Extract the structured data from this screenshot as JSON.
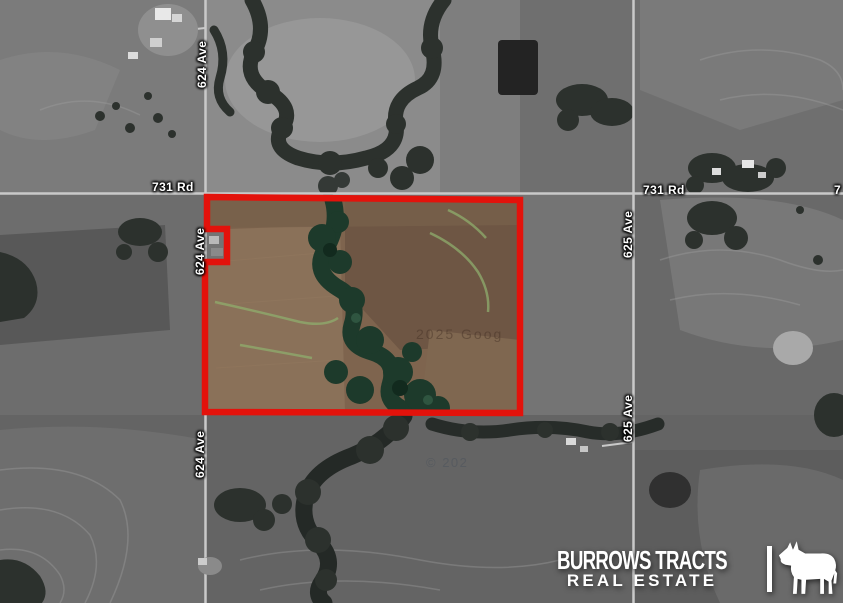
{
  "map": {
    "road_labels": [
      {
        "id": "624-ave-top",
        "text": "624 Ave"
      },
      {
        "id": "624-ave-mid",
        "text": "624 Ave"
      },
      {
        "id": "624-ave-bottom",
        "text": "624 Ave"
      },
      {
        "id": "625-ave-upper",
        "text": "625 Ave"
      },
      {
        "id": "625-ave-lower",
        "text": "625 Ave"
      },
      {
        "id": "731-rd-left",
        "text": "731 Rd"
      },
      {
        "id": "731-rd-right",
        "text": "731 Rd"
      },
      {
        "id": "731-rd-edge",
        "text": "7"
      }
    ],
    "watermarks": [
      {
        "id": "imagery-watermark-upper",
        "text": "2025 Goog"
      },
      {
        "id": "imagery-watermark-lower",
        "text": "© 202"
      }
    ],
    "parcel": {
      "outline_color": "#e3120b",
      "field_color": "#7e644e",
      "creek_color": "#1d3a2b"
    }
  },
  "logo": {
    "line1": "BURROWS TRACTS",
    "line2": "REAL ESTATE",
    "separator_icon": "vertical-bar",
    "animal_icon": "mule-silhouette",
    "text_color": "#ffffff"
  }
}
